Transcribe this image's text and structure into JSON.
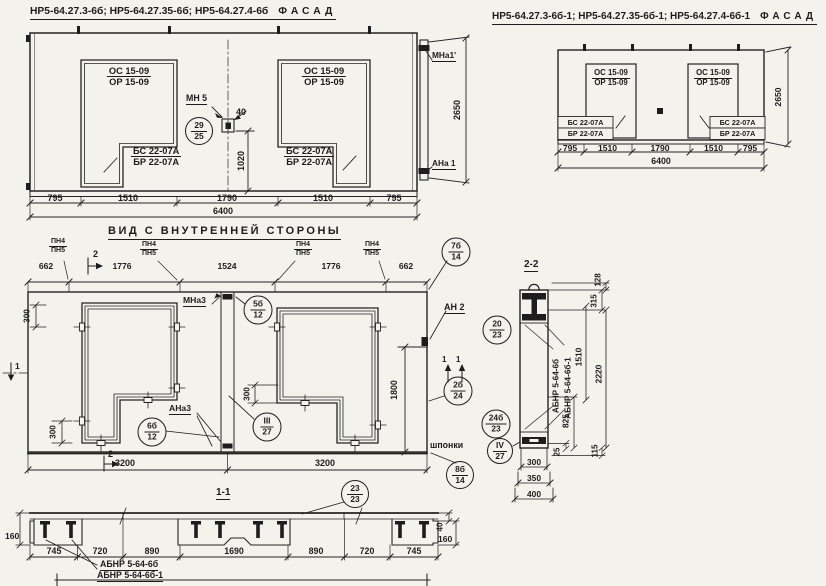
{
  "fl": {
    "title": "НР5-64.27.3-6б; НР5-64.27.35-6б; НР5-64.27.4-6б",
    "view_word": "ФАСАД",
    "windows": [
      {
        "top": "ОС 15-09",
        "bot": "ОР 15-09",
        "sill_top": "БС 22-07А",
        "sill_bot": "БР 22-07А"
      },
      {
        "top": "ОС 15-09",
        "bot": "ОР 15-09",
        "sill_top": "БС 22-07А",
        "sill_bot": "БР 22-07А"
      }
    ],
    "mn5": "МН 5",
    "c2925": {
      "n": "29",
      "d": "25"
    },
    "d40": "40",
    "d1020": "1020",
    "dims": [
      "795",
      "1510",
      "1790",
      "1510",
      "795"
    ],
    "total": "6400",
    "mna1": "МНа1'",
    "ana1": "АНа 1",
    "d2650": "2650"
  },
  "fr": {
    "title": "НР5-64.27.3-6б-1; НР5-64.27.35-6б-1; НР5-64.27.4-6б-1",
    "view_word": "ФАСАД",
    "windows": [
      {
        "top": "ОС 15-09",
        "bot": "ОР 15-09",
        "sill_top": "БС 22-07А",
        "sill_bot": "БР 22-07А"
      },
      {
        "top": "ОС 15-09",
        "bot": "ОР 15-09",
        "sill_top": "БС 22-07А",
        "sill_bot": "БР 22-07А"
      }
    ],
    "dims": [
      "795",
      "1510",
      "1790",
      "1510",
      "795"
    ],
    "total": "6400",
    "d2650": "2650"
  },
  "iv": {
    "title": "ВИД С ВНУТРЕННЕЙ СТОРОНЫ",
    "dims_top": [
      "662",
      "1776",
      "1524",
      "1776",
      "662"
    ],
    "pn": {
      "a": "ПН4",
      "b": "ПН5"
    },
    "mna3": "МНа3",
    "ana3": "АНа3",
    "an2": "АН 2",
    "d300": "300",
    "d1800": "1800",
    "d3200": "3200",
    "shponki": "шпонки",
    "m1": "1",
    "m2": "2",
    "c7b14": {
      "n": "7б",
      "d": "14"
    },
    "c5b12": {
      "n": "5б",
      "d": "12"
    },
    "c6b12": {
      "n": "6б",
      "d": "12"
    },
    "cIII27": {
      "n": "III",
      "d": "27"
    },
    "c2b24": {
      "n": "2б",
      "d": "24"
    }
  },
  "s22": {
    "title": "2-2",
    "c2023": {
      "n": "20",
      "d": "23"
    },
    "c24b23": {
      "n": "24б",
      "d": "23"
    },
    "cIV27": {
      "n": "IV",
      "d": "27"
    },
    "c8b14": {
      "n": "8б",
      "d": "14"
    },
    "abnr1": "АБНР 5-64-6б",
    "abnr2": "АБНР 5-64-6б-1",
    "d128": "128",
    "d315": "315",
    "d1510": "1510",
    "d2220": "2220",
    "d825": "825",
    "d25": "25",
    "d115": "115",
    "d300": "300",
    "d350": "350",
    "d400": "400"
  },
  "s11": {
    "title": "1-1",
    "c2323": {
      "n": "23",
      "d": "23"
    },
    "dims": [
      "745",
      "720",
      "890",
      "1690",
      "890",
      "720",
      "745"
    ],
    "d160l": "160",
    "d40": "40",
    "d160r": "160",
    "abnr1": "АБНР 5-64-6б",
    "abnr2": "АБНР 5-64-6б-1"
  }
}
